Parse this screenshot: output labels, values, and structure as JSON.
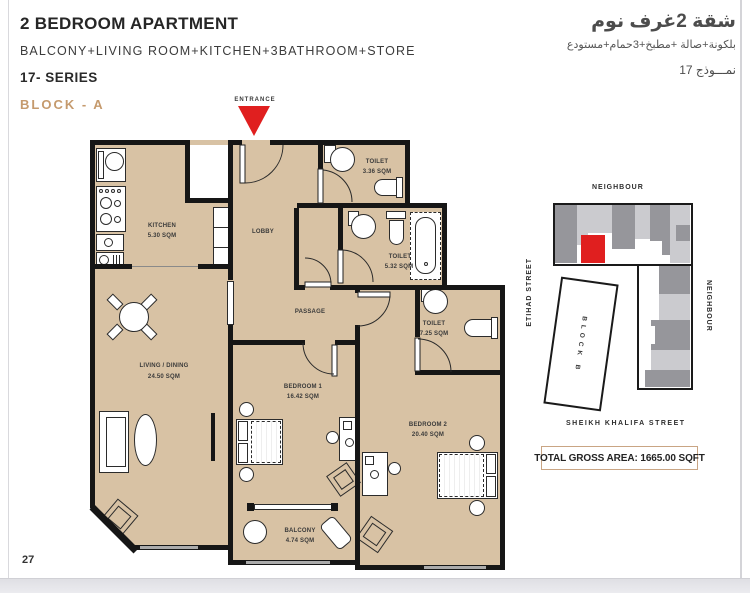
{
  "page": {
    "number": "27"
  },
  "header": {
    "title": "2 BEDROOM APARTMENT",
    "subtitle": "BALCONY+LIVING ROOM+KITCHEN+3BATHROOM+STORE",
    "series": "17- SERIES",
    "block": "BLOCK - A",
    "arabic_title": "شقة 2غرف نوم",
    "arabic_subtitle": "بلكونة+صالة +مطبخ+3حمام+مستودع",
    "arabic_model": "نمـــوذج 17"
  },
  "floor_plan": {
    "entrance_label": "ENTRANCE",
    "rooms": {
      "kitchen": {
        "name": "KITCHEN",
        "area": "5.30 SQM"
      },
      "lobby": {
        "name": "LOBBY"
      },
      "toilet_top": {
        "name": "TOILET",
        "area": "3.36 SQM"
      },
      "toilet_mid": {
        "name": "TOILET",
        "area": "5.32 SQM"
      },
      "toilet_right": {
        "name": "TOILET",
        "area": "7.25 SQM"
      },
      "passage": {
        "name": "PASSAGE"
      },
      "living": {
        "name": "LIVING / DINING",
        "area": "24.50 SQM"
      },
      "bedroom1": {
        "name": "BEDROOM 1",
        "area": "16.42 SQM"
      },
      "bedroom2": {
        "name": "BEDROOM 2",
        "area": "20.40 SQM"
      },
      "balcony": {
        "name": "BALCONY",
        "area": "4.74 SQM"
      }
    }
  },
  "site_map": {
    "neighbour_top": "NEIGHBOUR",
    "neighbour_right": "NEIGHBOUR",
    "street_left": "ETIHAD STREET",
    "street_bottom": "SHEIKH KHALIFA STREET",
    "block_b": "BLOCK B",
    "total_area": "TOTAL GROSS AREA: 1665.00 SQFT"
  },
  "colors": {
    "floor_tan": "#d8c2a4",
    "wall_black": "#161616",
    "accent_red": "#e01f1f",
    "block_label_gold": "#c59a6d",
    "site_gray_light": "#cbcbcf",
    "site_gray_dark": "#96969b",
    "area_box_border": "#c9a584"
  }
}
